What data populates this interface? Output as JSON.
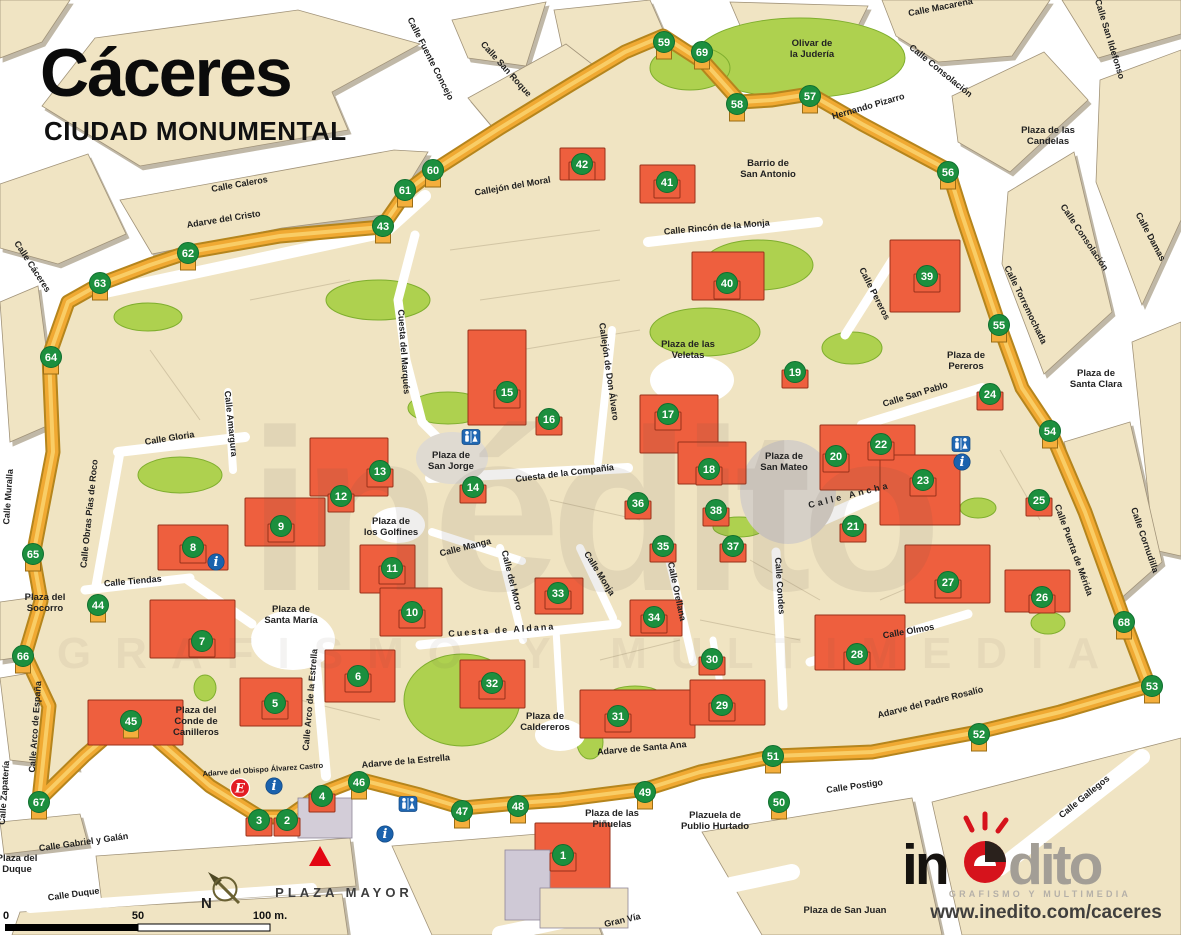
{
  "title": {
    "main": "Cáceres",
    "subtitle": "CIUDAD MONUMENTAL"
  },
  "branding": {
    "logo_in": "in",
    "logo_dito": "dito",
    "tagline": "GRAFISMO Y MULTIMEDIA",
    "website": "www.inedito.com/caceres",
    "logo_red": "#d6131c"
  },
  "scale_bar": {
    "labels": [
      "0",
      "50",
      "100 m."
    ]
  },
  "compass": {
    "x": 225,
    "y": 889,
    "label": "N"
  },
  "colors": {
    "marker_green": "#1c8f3e",
    "wall_gold": "#f0a932",
    "monument_red": "#ee5f3e",
    "icon_blue": "#2067b2",
    "badge_red": "#e31c23"
  },
  "watermark": {
    "word": "inédito",
    "tagline": "GRAFISMO Y MULTIMEDIA"
  },
  "markers": [
    [
      1,
      563,
      855
    ],
    [
      2,
      287,
      820
    ],
    [
      3,
      259,
      820
    ],
    [
      4,
      322,
      796
    ],
    [
      5,
      275,
      703
    ],
    [
      6,
      358,
      676
    ],
    [
      7,
      202,
      641
    ],
    [
      8,
      193,
      547
    ],
    [
      9,
      281,
      526
    ],
    [
      10,
      412,
      612
    ],
    [
      11,
      392,
      568
    ],
    [
      12,
      341,
      496
    ],
    [
      13,
      380,
      471
    ],
    [
      14,
      473,
      487
    ],
    [
      15,
      507,
      392
    ],
    [
      16,
      549,
      419
    ],
    [
      17,
      668,
      414
    ],
    [
      18,
      709,
      469
    ],
    [
      19,
      795,
      372
    ],
    [
      20,
      836,
      456
    ],
    [
      21,
      853,
      526
    ],
    [
      22,
      881,
      444
    ],
    [
      23,
      923,
      480
    ],
    [
      24,
      990,
      394
    ],
    [
      25,
      1039,
      500
    ],
    [
      26,
      1042,
      597
    ],
    [
      27,
      948,
      582
    ],
    [
      28,
      857,
      654
    ],
    [
      29,
      722,
      705
    ],
    [
      30,
      712,
      659
    ],
    [
      31,
      618,
      716
    ],
    [
      32,
      492,
      683
    ],
    [
      33,
      558,
      593
    ],
    [
      34,
      654,
      617
    ],
    [
      35,
      663,
      546
    ],
    [
      36,
      638,
      503
    ],
    [
      37,
      733,
      546
    ],
    [
      38,
      716,
      510
    ],
    [
      39,
      927,
      276
    ],
    [
      40,
      727,
      283
    ],
    [
      41,
      667,
      182
    ],
    [
      42,
      582,
      164
    ],
    [
      43,
      383,
      226
    ],
    [
      44,
      98,
      605
    ],
    [
      45,
      131,
      721
    ],
    [
      46,
      359,
      782
    ],
    [
      47,
      462,
      811
    ],
    [
      48,
      518,
      806
    ],
    [
      49,
      645,
      792
    ],
    [
      50,
      779,
      802
    ],
    [
      51,
      773,
      756
    ],
    [
      52,
      979,
      734
    ],
    [
      53,
      1152,
      686
    ],
    [
      54,
      1050,
      431
    ],
    [
      55,
      999,
      325
    ],
    [
      56,
      948,
      172
    ],
    [
      57,
      810,
      96
    ],
    [
      58,
      737,
      104
    ],
    [
      59,
      664,
      42
    ],
    [
      60,
      433,
      170
    ],
    [
      61,
      405,
      190
    ],
    [
      62,
      188,
      253
    ],
    [
      63,
      100,
      283
    ],
    [
      64,
      51,
      357
    ],
    [
      65,
      33,
      554
    ],
    [
      66,
      23,
      656
    ],
    [
      67,
      39,
      802
    ],
    [
      68,
      1124,
      622
    ],
    [
      69,
      702,
      52
    ]
  ],
  "streets": [
    {
      "t": "Calle Caleros",
      "x": 240,
      "y": 187,
      "r": -10
    },
    {
      "t": "Calle Cáceres",
      "x": 30,
      "y": 268,
      "r": 57
    },
    {
      "t": "Calle Fuente Concejo",
      "x": 428,
      "y": 60,
      "r": 63
    },
    {
      "t": "Calle San Roque",
      "x": 504,
      "y": 71,
      "r": 48
    },
    {
      "t": "Callejón del Moral",
      "x": 513,
      "y": 189,
      "r": -10
    },
    {
      "t": "Calle Macarena",
      "x": 941,
      "y": 10,
      "r": -11
    },
    {
      "t": "Calle San Ildefonso",
      "x": 1107,
      "y": 40,
      "r": 73
    },
    {
      "t": "Calle Consolación",
      "x": 939,
      "y": 73,
      "r": 39
    },
    {
      "t": "Hernando Pizarro",
      "x": 869,
      "y": 109,
      "r": -16
    },
    {
      "t": "Calle Consolación",
      "x": 1082,
      "y": 239,
      "r": 56
    },
    {
      "t": "Calle Damas",
      "x": 1148,
      "y": 238,
      "r": 62
    },
    {
      "t": "Calle Torremochada",
      "x": 1023,
      "y": 306,
      "r": 64
    },
    {
      "t": "Calle Pereros",
      "x": 872,
      "y": 295,
      "r": 63
    },
    {
      "t": "Calle San Pablo",
      "x": 916,
      "y": 397,
      "r": -17
    },
    {
      "t": "Adarve del Cristo",
      "x": 224,
      "y": 222,
      "r": -9
    },
    {
      "t": "Calle Obras Pías de Roco",
      "x": 92,
      "y": 514,
      "r": -84
    },
    {
      "t": "Calle Muralla",
      "x": 11,
      "y": 497,
      "r": -86
    },
    {
      "t": "Calle Gloria",
      "x": 170,
      "y": 441,
      "r": -9
    },
    {
      "t": "Calle Amargura",
      "x": 228,
      "y": 424,
      "r": 84
    },
    {
      "t": "Cuesta del Marqués",
      "x": 401,
      "y": 352,
      "r": 86
    },
    {
      "t": "Callejón de Don Álvaro",
      "x": 606,
      "y": 372,
      "r": 82
    },
    {
      "t": "Cuesta de la Compañía",
      "x": 565,
      "y": 476,
      "r": -7
    },
    {
      "t": "Calle Manga",
      "x": 466,
      "y": 550,
      "r": -14
    },
    {
      "t": "Calle del Moro",
      "x": 509,
      "y": 581,
      "r": 76
    },
    {
      "t": "Cuesta de Aldana",
      "x": 502,
      "y": 633,
      "r": -4,
      "ls": 2
    },
    {
      "t": "Calle Monja",
      "x": 597,
      "y": 575,
      "r": 58
    },
    {
      "t": "Calle Orellana",
      "x": 674,
      "y": 592,
      "r": 78
    },
    {
      "t": "Calle Condes",
      "x": 777,
      "y": 586,
      "r": 86
    },
    {
      "t": "Calle Ancha",
      "x": 850,
      "y": 498,
      "r": -14,
      "ls": 3
    },
    {
      "t": "Calle Olmos",
      "x": 909,
      "y": 634,
      "r": -10
    },
    {
      "t": "Calle Puerta de Mérida",
      "x": 1071,
      "y": 551,
      "r": 70
    },
    {
      "t": "Calle Cornudilla",
      "x": 1142,
      "y": 541,
      "r": 71
    },
    {
      "t": "Adarve del Padre Rosalío",
      "x": 931,
      "y": 705,
      "r": -14
    },
    {
      "t": "Calle Postigo",
      "x": 855,
      "y": 789,
      "r": -8
    },
    {
      "t": "Calle Gallegos",
      "x": 1086,
      "y": 799,
      "r": -39
    },
    {
      "t": "Adarve de Santa Ana",
      "x": 642,
      "y": 751,
      "r": -5
    },
    {
      "t": "Adarve de la Estrella",
      "x": 406,
      "y": 764,
      "r": -5
    },
    {
      "t": "Adarve del Obispo Álvarez Castro",
      "x": 263,
      "y": 772,
      "r": -4,
      "s": 7.5
    },
    {
      "t": "Calle Arco de la Estrella",
      "x": 313,
      "y": 700,
      "r": -85
    },
    {
      "t": "Calle Arco de España",
      "x": 38,
      "y": 727,
      "r": -86
    },
    {
      "t": "Calle Zapatería",
      "x": 7,
      "y": 793,
      "r": -86
    },
    {
      "t": "Calle Gabriel y Galán",
      "x": 84,
      "y": 845,
      "r": -8
    },
    {
      "t": "Calle Duque",
      "x": 74,
      "y": 897,
      "r": -8
    },
    {
      "t": "Gran Vía",
      "x": 623,
      "y": 923,
      "r": -13
    },
    {
      "t": "Calle Tiendas",
      "x": 133,
      "y": 584,
      "r": -5
    },
    {
      "t": "Calle Rincón de la Monja",
      "x": 717,
      "y": 230,
      "r": -5
    }
  ],
  "areas": [
    {
      "lines": [
        "Barrio de",
        "San Antonio"
      ],
      "x": 768,
      "y": 166
    },
    {
      "lines": [
        "Olivar de",
        "la Judería"
      ],
      "x": 812,
      "y": 46
    },
    {
      "lines": [
        "Plaza de las",
        "Candelas"
      ],
      "x": 1048,
      "y": 133
    },
    {
      "lines": [
        "Plaza de",
        "Pereros"
      ],
      "x": 966,
      "y": 358
    },
    {
      "lines": [
        "Plaza de las",
        "Veletas"
      ],
      "x": 688,
      "y": 347
    },
    {
      "lines": [
        "Plaza de",
        "Santa Clara"
      ],
      "x": 1096,
      "y": 376
    },
    {
      "lines": [
        "Plaza de",
        "San Jorge"
      ],
      "x": 451,
      "y": 458
    },
    {
      "lines": [
        "Plaza de",
        "los Golfines"
      ],
      "x": 391,
      "y": 524
    },
    {
      "lines": [
        "Plaza de",
        "San Mateo"
      ],
      "x": 784,
      "y": 459
    },
    {
      "lines": [
        "Plaza del",
        "Socorro"
      ],
      "x": 45,
      "y": 600
    },
    {
      "lines": [
        "Plaza de",
        "Santa María"
      ],
      "x": 291,
      "y": 612
    },
    {
      "lines": [
        "Plaza del",
        "Conde de",
        "Canilleros"
      ],
      "x": 196,
      "y": 713
    },
    {
      "lines": [
        "Plaza de",
        "Caldereros"
      ],
      "x": 545,
      "y": 719
    },
    {
      "lines": [
        "Plaza de las",
        "Piñuelas"
      ],
      "x": 612,
      "y": 816
    },
    {
      "lines": [
        "Plazuela de",
        "Publio Hurtado"
      ],
      "x": 715,
      "y": 818
    },
    {
      "lines": [
        "Plaza del",
        "Duque"
      ],
      "x": 17,
      "y": 861
    },
    {
      "lines": [
        "Plaza de San Juan"
      ],
      "x": 845,
      "y": 913
    },
    {
      "lines": [
        "PLAZA MAYOR"
      ],
      "x": 344,
      "y": 897,
      "cls": "major"
    }
  ],
  "icons": {
    "wc": [
      [
        471,
        437
      ],
      [
        961,
        444
      ],
      [
        408,
        804
      ]
    ],
    "info": [
      [
        216,
        562
      ],
      [
        962,
        462
      ],
      [
        274,
        786
      ],
      [
        385,
        834
      ]
    ],
    "e_badge": [
      240,
      788
    ],
    "triangle": [
      320,
      856
    ]
  }
}
